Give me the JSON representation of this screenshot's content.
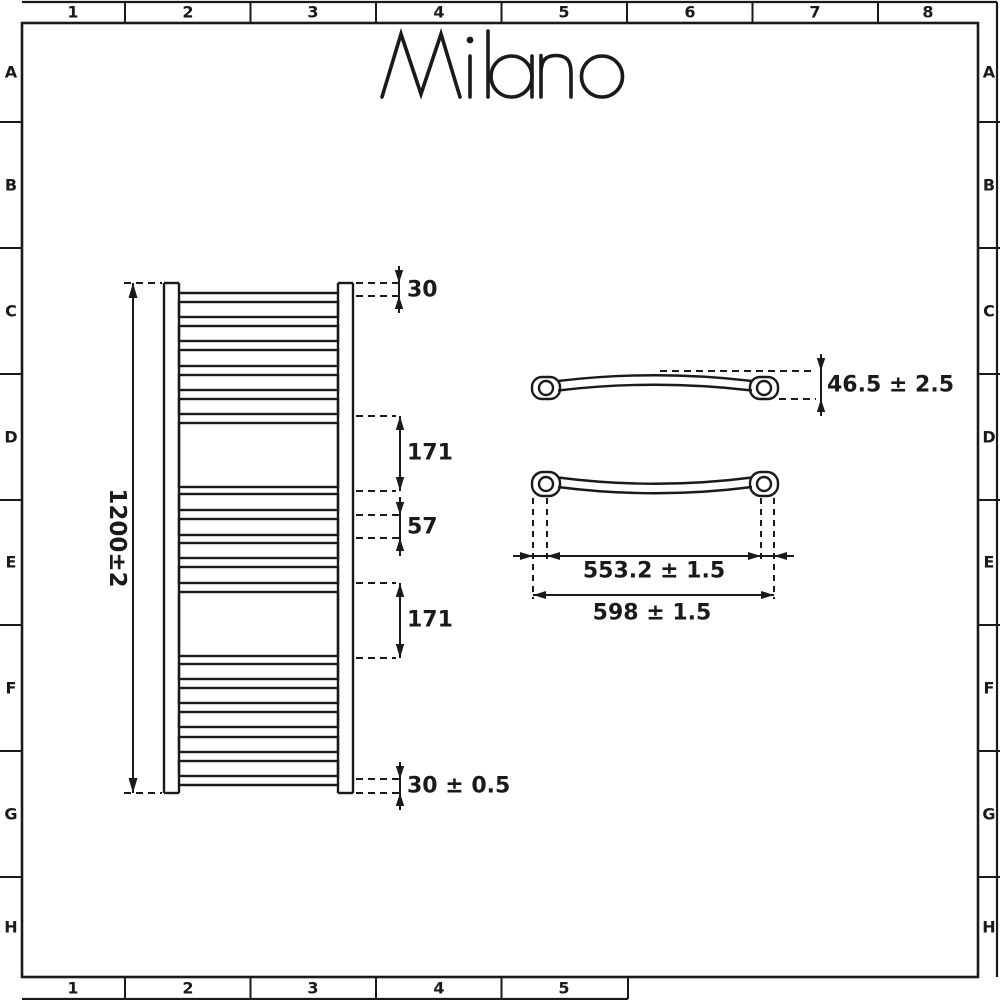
{
  "page": {
    "background": "#ffffff",
    "line_color": "#1a1a1a"
  },
  "brand": {
    "logo_text": "Milano"
  },
  "grid_frame": {
    "column_labels_top": [
      "1",
      "2",
      "3",
      "4",
      "5",
      "6",
      "7",
      "8"
    ],
    "column_labels_bottom": [
      "1",
      "2",
      "3",
      "4",
      "5"
    ],
    "row_labels": [
      "A",
      "B",
      "C",
      "D",
      "E",
      "F",
      "G",
      "H"
    ]
  },
  "front_view": {
    "overall_height": "1200±2",
    "top_offset": "30",
    "upper_panel_height": "171",
    "rung_pitch": "57",
    "lower_panel_height": "171",
    "bottom_offset": "30 ± 0.5"
  },
  "top_view": {
    "depth": "46.5 ± 2.5",
    "fixing_centres": "553.2 ± 1.5",
    "overall_width": "598 ± 1.5"
  }
}
